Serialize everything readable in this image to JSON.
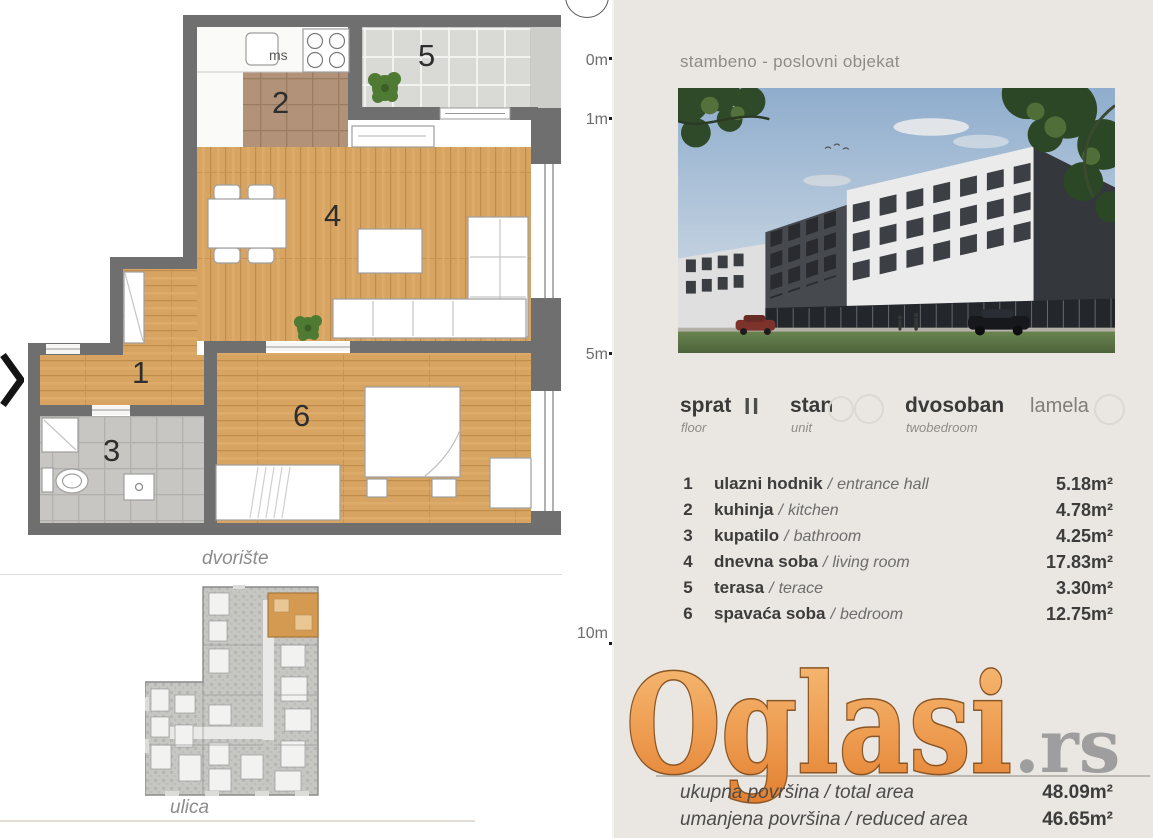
{
  "left": {
    "floor_plan": {
      "room_numbers": [
        "1",
        "2",
        "3",
        "4",
        "5",
        "6"
      ],
      "kitchen_appliance_label": "ms",
      "courtyard_label": "dvorište",
      "street_label": "ulica"
    }
  },
  "ruler": {
    "marks": [
      {
        "label": "0m"
      },
      {
        "label": "1m"
      },
      {
        "label": "5m"
      },
      {
        "label": "10m"
      }
    ]
  },
  "right": {
    "header": "stambeno - poslovni objekat",
    "unit_info": {
      "floor_label": "sprat",
      "floor_sub": "floor",
      "floor_value": "II",
      "unit_label": "stan",
      "unit_sub": "unit",
      "type_label": "dvosoban",
      "type_sub": "twobedroom",
      "lamela_label": "lamela"
    },
    "sep": "/",
    "rooms": [
      {
        "num": "1",
        "name": "ulazni hodnik",
        "name_en": "entrance hall",
        "area": "5.18m²"
      },
      {
        "num": "2",
        "name": "kuhinja",
        "name_en": "kitchen",
        "area": "4.78m²"
      },
      {
        "num": "3",
        "name": "kupatilo",
        "name_en": "bathroom",
        "area": "4.25m²"
      },
      {
        "num": "4",
        "name": "dnevna soba",
        "name_en": "living room",
        "area": "17.83m²"
      },
      {
        "num": "5",
        "name": "terasa",
        "name_en": "terace",
        "area": "3.30m²"
      },
      {
        "num": "6",
        "name": "spavaća soba",
        "name_en": "bedroom",
        "area": "12.75m²"
      }
    ],
    "totals": [
      {
        "label": "ukupna površina",
        "label_en": "total area",
        "area": "48.09m²"
      },
      {
        "label": "umanjena površina",
        "label_en": "reduced area",
        "area": "46.65m²"
      }
    ],
    "watermark": {
      "brand": "Oglasi",
      "tld": ".rs"
    }
  },
  "colors": {
    "panel_bg": "#eae6e1",
    "wall_gray": "#6f6f6f",
    "wood": "#d8a462",
    "logo_orange": "#e8913f",
    "highlight_unit_orange": "#d59a52"
  }
}
